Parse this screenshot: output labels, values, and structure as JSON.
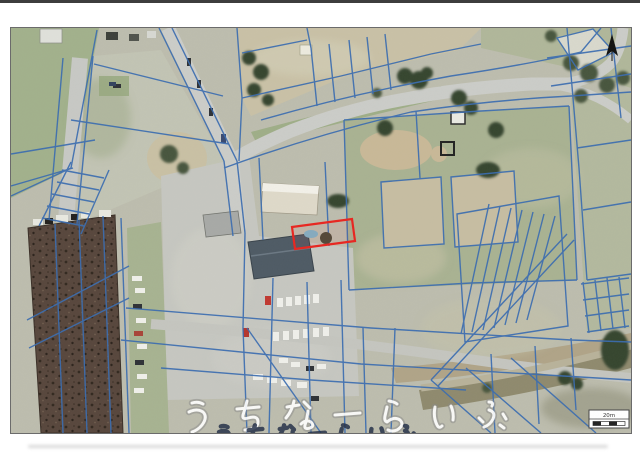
{
  "page": {
    "background": "#ffffff",
    "top_edge_bar_color": "#3d3d3d"
  },
  "map": {
    "kind": "aerial photo with cadastral parcel overlay",
    "watermark_text": "うちなーらいふ",
    "scale_bar": {
      "label": "20m"
    },
    "colors": {
      "parcel_line": "#3a6cb0",
      "highlight_outline": "#e8251f",
      "photo_border": "#6b6b6b",
      "watermark": "#ffffff"
    },
    "icons": {
      "north_arrow": "north-arrow-icon",
      "scale_bar": "scale-bar"
    }
  }
}
